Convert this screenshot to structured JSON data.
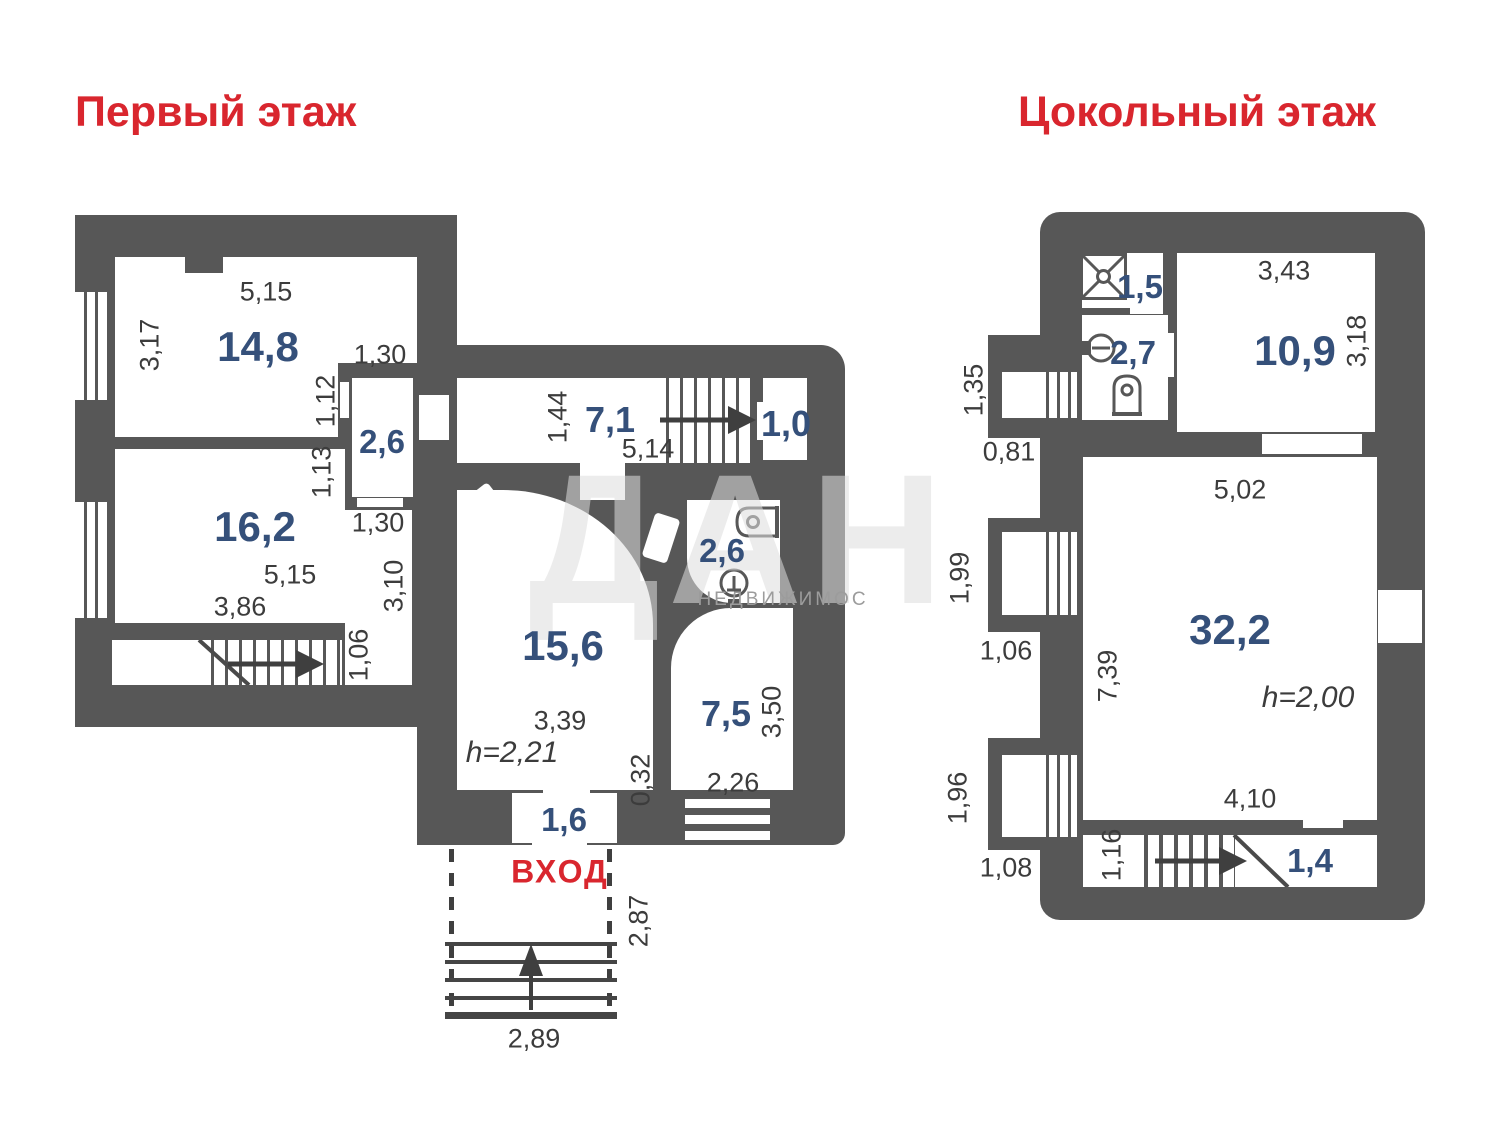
{
  "titles": {
    "first_floor": "Первый этаж",
    "basement": "Цокольный этаж"
  },
  "watermark": {
    "big": "ДАН",
    "small": "НЕДВИЖИМОС"
  },
  "first_floor": {
    "room_14_8": {
      "area": "14,8",
      "width": "5,15",
      "depth": "3,17"
    },
    "closet_2_6": {
      "area": "2,6",
      "top": "1,30",
      "side_upper": "1,12",
      "side_lower": "1,13",
      "bottom": "1,30"
    },
    "room_16_2": {
      "area": "16,2",
      "width": "5,15",
      "width2": "3,86",
      "depth": "3,10",
      "stair_opening": "1,06"
    },
    "hall_7_1": {
      "area": "7,1",
      "depth": "1,44",
      "width": "5,14"
    },
    "landing_1_0": {
      "area": "1,0"
    },
    "bath_2_6": {
      "area": "2,6"
    },
    "living_15_6": {
      "area": "15,6",
      "width": "3,39",
      "ceiling": "h=2,21",
      "wall_gap": "0,32"
    },
    "room_7_5": {
      "area": "7,5",
      "depth": "3,50",
      "width": "2,26"
    },
    "tambour_1_6": {
      "area": "1,6"
    },
    "entrance": {
      "label": "ВХОД",
      "depth": "2,87",
      "width": "2,89"
    }
  },
  "basement": {
    "shower_1_5": {
      "area": "1,5"
    },
    "wc_2_7": {
      "area": "2,7"
    },
    "room_10_9": {
      "area": "10,9",
      "width": "3,43",
      "depth": "3,18"
    },
    "room_32_2": {
      "area": "32,2",
      "width": "5,02",
      "depth": "7,39",
      "ceiling": "h=2,00",
      "stair_width": "4,10"
    },
    "stairs": {
      "width": "1,16"
    },
    "room_1_4": {
      "area": "1,4"
    },
    "exterior": {
      "d1": "1,35",
      "d2": "0,81",
      "d3": "1,99",
      "d4": "1,06",
      "d5": "1,96",
      "d6": "1,08"
    }
  }
}
